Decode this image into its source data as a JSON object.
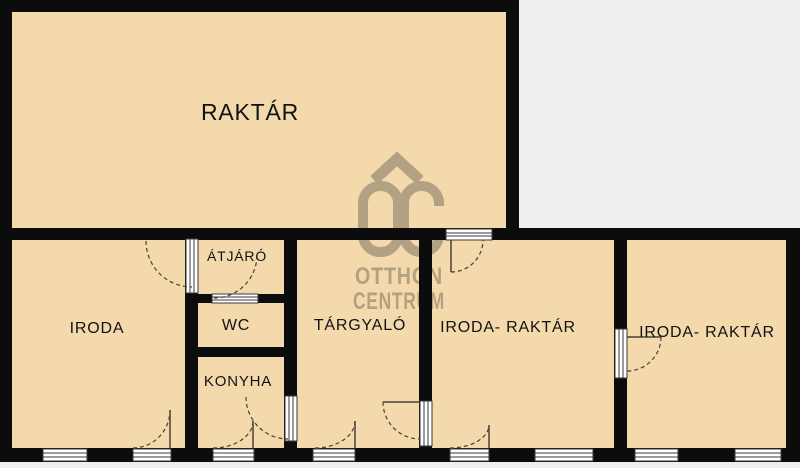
{
  "plan_title": "floor-plan",
  "rooms": {
    "raktar": "RAKTÁR",
    "iroda": "IRODA",
    "atjaro": "ÁTJÁRÓ",
    "wc": "WC",
    "konyha": "KONYHA",
    "targyalo": "TÁRGYALÓ",
    "iroda_raktar_1": "IRODA- RAKTÁR",
    "iroda_raktar_2": "IRODA- RAKTÁR"
  },
  "watermark": {
    "monogram": "OC",
    "line1": "OTTHON",
    "line2": "CENTRUM"
  },
  "colors": {
    "floor_fill": "#f3d9ab",
    "wall": "#0c0c0c",
    "background": "#f0efed",
    "watermark": "#b2a283",
    "opening_frame": "#ffffff",
    "door_swing": "#4a4039"
  }
}
